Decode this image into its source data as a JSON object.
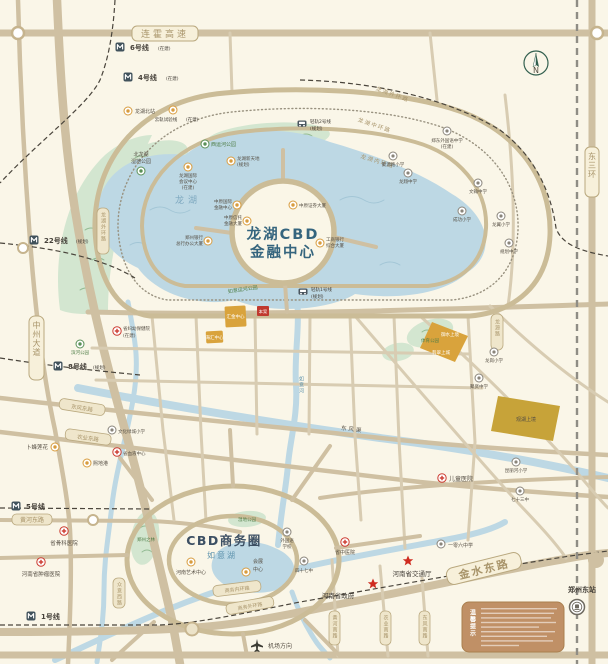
{
  "roads": {
    "lianhuo": "连霍高速",
    "dongsanhuan": "东三环",
    "zhongzhou": "中州大道",
    "jinshui": "金水东路",
    "longhu_outer": "龙湖外环路",
    "longhu_middle": "龙湖中环路",
    "longhu_inner": "龙湖内环路",
    "longhu_west": "龙湖外环路",
    "longyuan": "龙源路",
    "dongfeng_e": "东风东路",
    "nongye_e": "农业东路",
    "huanghe_e": "黄河东路",
    "zhongyi_w": "众意西路",
    "huanghe_s": "黄河南路",
    "nongye_s": "农业南路",
    "dongfeng_s": "东风南路",
    "shangwu_inner": "商务内环路",
    "shangwu_outer": "商务外环路"
  },
  "metro": {
    "l6": {
      "name": "6号线",
      "status": "(在建)"
    },
    "l4": {
      "name": "4号线",
      "status": "(在建)"
    },
    "l22": {
      "name": "22号线",
      "status": "(规划)"
    },
    "l8": {
      "name": "8号线",
      "status": "(规划)"
    },
    "l5": {
      "name": "5号线",
      "status": ""
    },
    "l1": {
      "name": "1号线",
      "status": ""
    },
    "lr2": {
      "name": "轻轨2号线",
      "status": "(规划)"
    },
    "lr1": {
      "name": "轻轨1号线",
      "status": "(规划)"
    },
    "yungui": {
      "name": "云轨试验线",
      "status": "(在建)"
    }
  },
  "water": {
    "longhu": "龙湖",
    "ruyihu": "如意湖",
    "ruyihe": "如意河",
    "dongfengqu": "东风渠"
  },
  "center": {
    "line1": "龙湖CBD",
    "line2": "金融中心"
  },
  "cbd_title": "CBD商务圈",
  "towers": [
    {
      "l1": "中原国际",
      "l2": "金融中心"
    },
    {
      "l1": "中原信托",
      "l2": "金融大厦"
    },
    {
      "l1": "中原证券大厦",
      "l2": ""
    },
    {
      "l1": "工商银行",
      "l2": "综合大厦"
    },
    {
      "l1": "郑州银行",
      "l2": "总行办公大厦"
    }
  ],
  "pois": {
    "longhubei": "龙湖北站",
    "xiyunhe_park": "西运河公园",
    "wetland1": "北龙湖",
    "wetland2": "湿地公园",
    "huiyi1": "龙湖国际",
    "huiyi2": "会议中心",
    "huiyi3": "(在建)",
    "xintiandi1": "龙湖新天地",
    "xintiandi2": "(规划)",
    "ruyi_canal_park": "如意运河公园",
    "huizhan1": "会展",
    "huizhan2": "中心",
    "yishu": "河南艺术中心",
    "bufeng": "卜蜂莲花",
    "xidigang": "熙地港",
    "airport": "机场方向",
    "dongzhan": "郑州东站"
  },
  "parks": {
    "zhilin": "郑州之林",
    "shidi": "湿地公园",
    "tiyu": "体育公园",
    "binhe": "滨河公园"
  },
  "schools": [
    {
      "name": "郑东外国语中学",
      "name2": "(在建)"
    },
    {
      "name": "聚源路小学",
      "name2": ""
    },
    {
      "name": "龙翔中学",
      "name2": ""
    },
    {
      "name": "文翰中学",
      "name2": ""
    },
    {
      "name": "成功小学",
      "name2": ""
    },
    {
      "name": "龙翼小学",
      "name2": ""
    },
    {
      "name": "规划中学",
      "name2": ""
    },
    {
      "name": "龙岗小学",
      "name2": ""
    },
    {
      "name": "聚贤中学",
      "name2": ""
    },
    {
      "name": "昆丽河小学",
      "name2": ""
    },
    {
      "name": "七十三中",
      "name2": ""
    },
    {
      "name": "四十七中",
      "name2": ""
    },
    {
      "name": "外国语",
      "name2": "学校"
    },
    {
      "name": "一零六中学",
      "name2": ""
    },
    {
      "name": "文化绿城小学",
      "name2": ""
    }
  ],
  "hospitals": [
    {
      "name": "省骨科医院",
      "name2": ""
    },
    {
      "name": "河南省肿瘤医院",
      "name2": ""
    },
    {
      "name": "儿童医院",
      "name2": ""
    },
    {
      "name": "省妇幼保健院",
      "name2": "(在建)"
    },
    {
      "name": "省血液中心",
      "name2": ""
    },
    {
      "name": "省中医院",
      "name2": ""
    }
  ],
  "gov": {
    "jiaotongting": "河南省交通厅",
    "zhengfu": "河南省政府"
  },
  "parcels": {
    "a": "汇金中心",
    "b": "海汇中心",
    "c": "御水上境",
    "d": "翡翠上城",
    "e": "观湖上境"
  },
  "site": "本案",
  "notice_title": "温馨提示",
  "compass": "N"
}
